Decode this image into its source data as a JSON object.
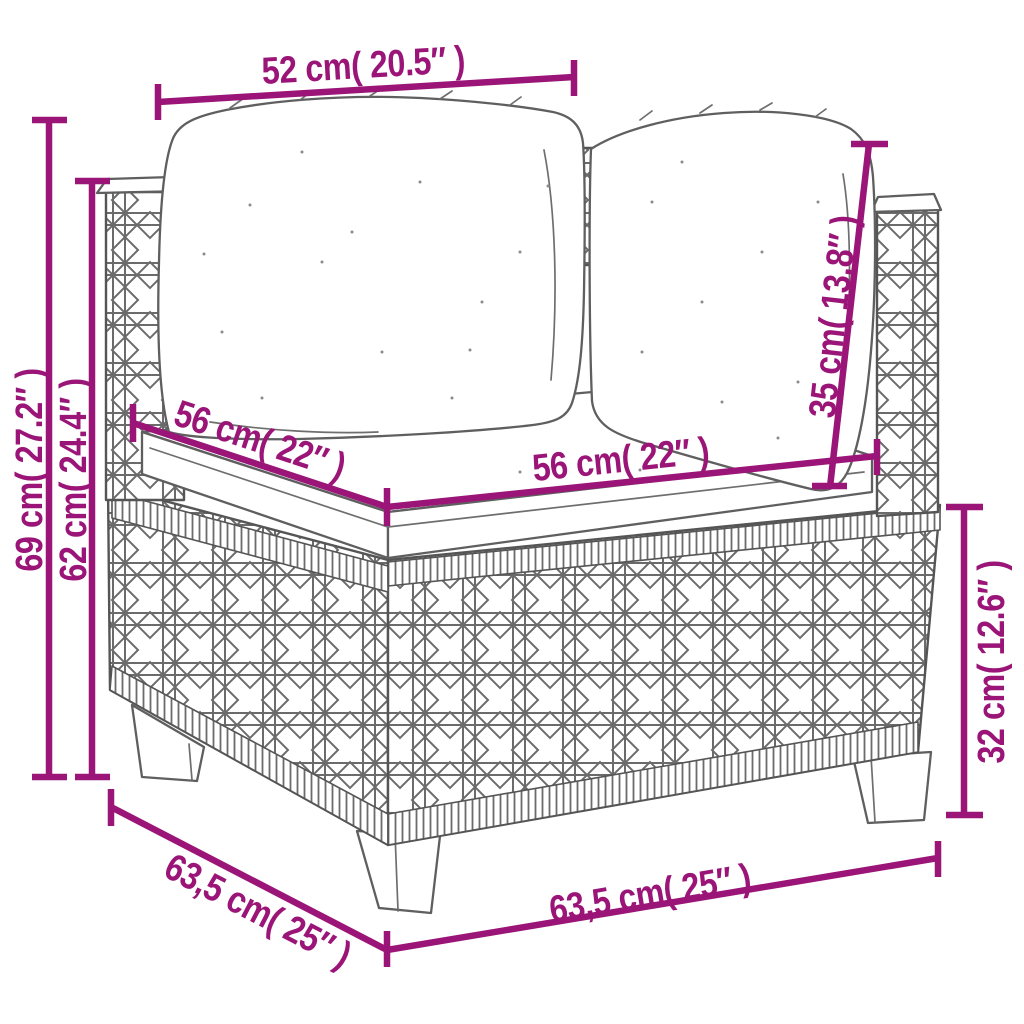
{
  "colors": {
    "accent": "#9A1577",
    "sketch_line": "#5f5f5f",
    "background": "#ffffff"
  },
  "diagram": {
    "subject": "rattan-corner-sofa-with-cushions",
    "dimensions": {
      "top_width": {
        "label": "52 cm( 20.5″ )",
        "cm": "52",
        "inches": "20.5″"
      },
      "total_height": {
        "label": "69 cm( 27.2″ )",
        "cm": "69",
        "inches": "27.2″"
      },
      "arm_height": {
        "label": "62 cm( 24.4″ )",
        "cm": "62",
        "inches": "24.4″"
      },
      "seat_depth": {
        "label": "56 cm( 22″ )",
        "cm": "56",
        "inches": "22″"
      },
      "seat_width": {
        "label": "56 cm( 22″ )",
        "cm": "56",
        "inches": "22″"
      },
      "back_cushion_height": {
        "label": "35 cm( 13.8″ )",
        "cm": "35",
        "inches": "13.8″"
      },
      "base_height": {
        "label": "32 cm( 12.6″ )",
        "cm": "32",
        "inches": "12.6″"
      },
      "bottom_depth": {
        "label": "63,5 cm( 25″ )",
        "cm": "63,5",
        "inches": "25″"
      },
      "bottom_width": {
        "label": "63,5 cm( 25″ )",
        "cm": "63,5",
        "inches": "25″"
      }
    }
  }
}
